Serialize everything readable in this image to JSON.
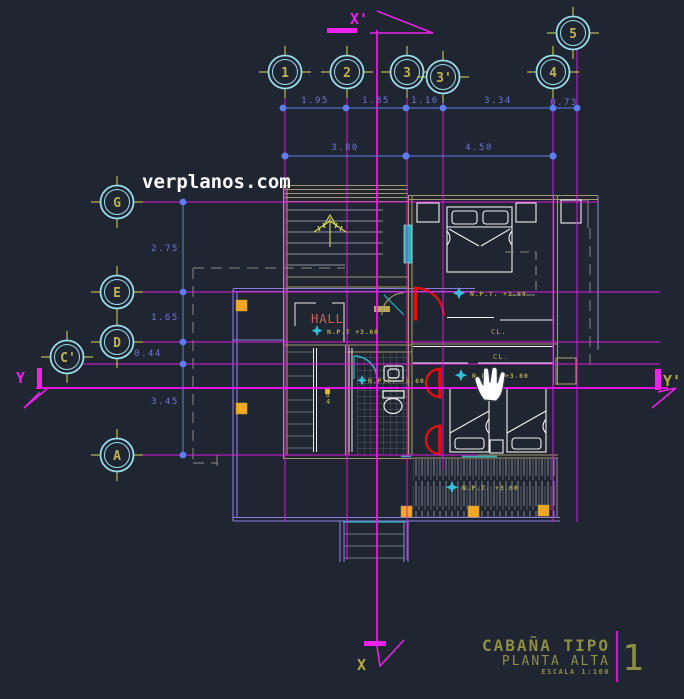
{
  "watermark": "verplanos.com",
  "grid_bubbles": {
    "top": [
      "1",
      "2",
      "3",
      "3'",
      "4",
      "5"
    ],
    "left": [
      "G",
      "E",
      "D",
      "C'",
      "A"
    ]
  },
  "axis_markers": {
    "top": "X'",
    "bottom": "X",
    "left": "Y",
    "right": "Y'"
  },
  "dimensions": {
    "row1": [
      "1.95",
      "1.85",
      "1.16",
      "3.34",
      "0.73"
    ],
    "row2": [
      "3.80",
      "4.50"
    ],
    "left_col": [
      "2.75",
      "1.65",
      "0.44",
      "3.45"
    ]
  },
  "labels": {
    "hall": "HALL",
    "npt": "N.P.T. +3.60",
    "npt_hall": "N.P.T +3.60",
    "closet": "CL.",
    "stair_ref_letter": "B",
    "stair_ref_number": "4"
  },
  "title_block": {
    "title": "CABAÑA TIPO",
    "subtitle": "PLANTA ALTA",
    "scale": "ESCALA 1:100",
    "sheet_number": "1"
  },
  "colors": {
    "background": "#1f2631",
    "grid_magenta": "#de16de",
    "axis_magenta": "#ff10ff",
    "bubble_cyan": "#9adcec",
    "annotation_yellow": "#d8d855",
    "olive_text": "#c3b253",
    "dimension_blue": "#5f7df0",
    "wall_tan": "#a6966a",
    "deck_purple": "#8a7ae0",
    "door_red": "#e01010",
    "window_teal": "#2bb3bd",
    "column_orange": "#f5a623",
    "hall_salmon": "#c4685a",
    "title_olive": "#8e8e44",
    "white": "#f2f2f2"
  }
}
